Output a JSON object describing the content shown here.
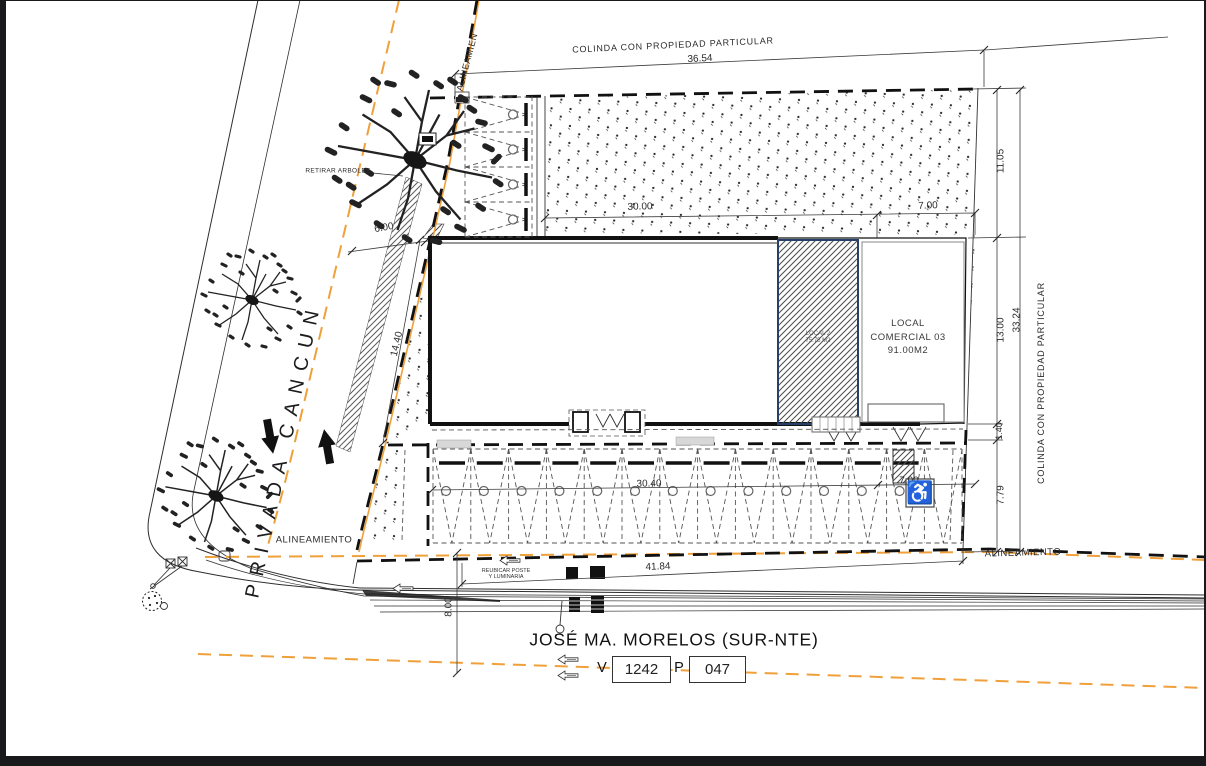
{
  "drawing": {
    "streets": {
      "left": "PRIVADA CANCUN",
      "bottom": "JOSÉ MA. MORELOS (SUR-NTE)"
    },
    "boundaries": {
      "top": "COLINDA CON PROPIEDAD PARTICULAR",
      "right": "COLINDA CON PROPIEDAD PARTICULAR",
      "alignment_top_left": "ALINEAMIEN",
      "alignment_left": "ALINEAMIENTO",
      "alignment_right": "ALINEAMIENTO"
    },
    "notes": {
      "remove_trees": "RETIRAR ARBOLES",
      "relocate_pole_1": "REUBICAR POSTE",
      "relocate_pole_2": "Y LUMINARIA"
    },
    "units": {
      "local2_line1": "LOCAL 2",
      "local2_line2": "75.75 M2",
      "local3_line1": "LOCAL",
      "local3_line2": "COMERCIAL 03",
      "local3_line3": "91.00M2"
    },
    "dimensions": {
      "top": "36.54",
      "right_upper": "11.05",
      "right_mid": "13.00",
      "right_small": "1.40",
      "right_lower": "7.79",
      "right_total": "33.24",
      "bldg_top_left": "30.00",
      "bldg_top_right": "7.00",
      "left_side": "14.40",
      "front_offset": "6.00",
      "parking_row": "30.40",
      "parking_right": "7.00",
      "frontage": "41.84",
      "street_half": "8.00"
    },
    "road_plate": {
      "v_label": "V",
      "v_value": "1242",
      "p_label": "P",
      "p_value": "047"
    },
    "icons": {
      "wheelchair": "♿"
    },
    "colors": {
      "accent_orange": "#F0A03A",
      "line": "#1d1d1f",
      "hatch_border": "#27406b"
    }
  }
}
